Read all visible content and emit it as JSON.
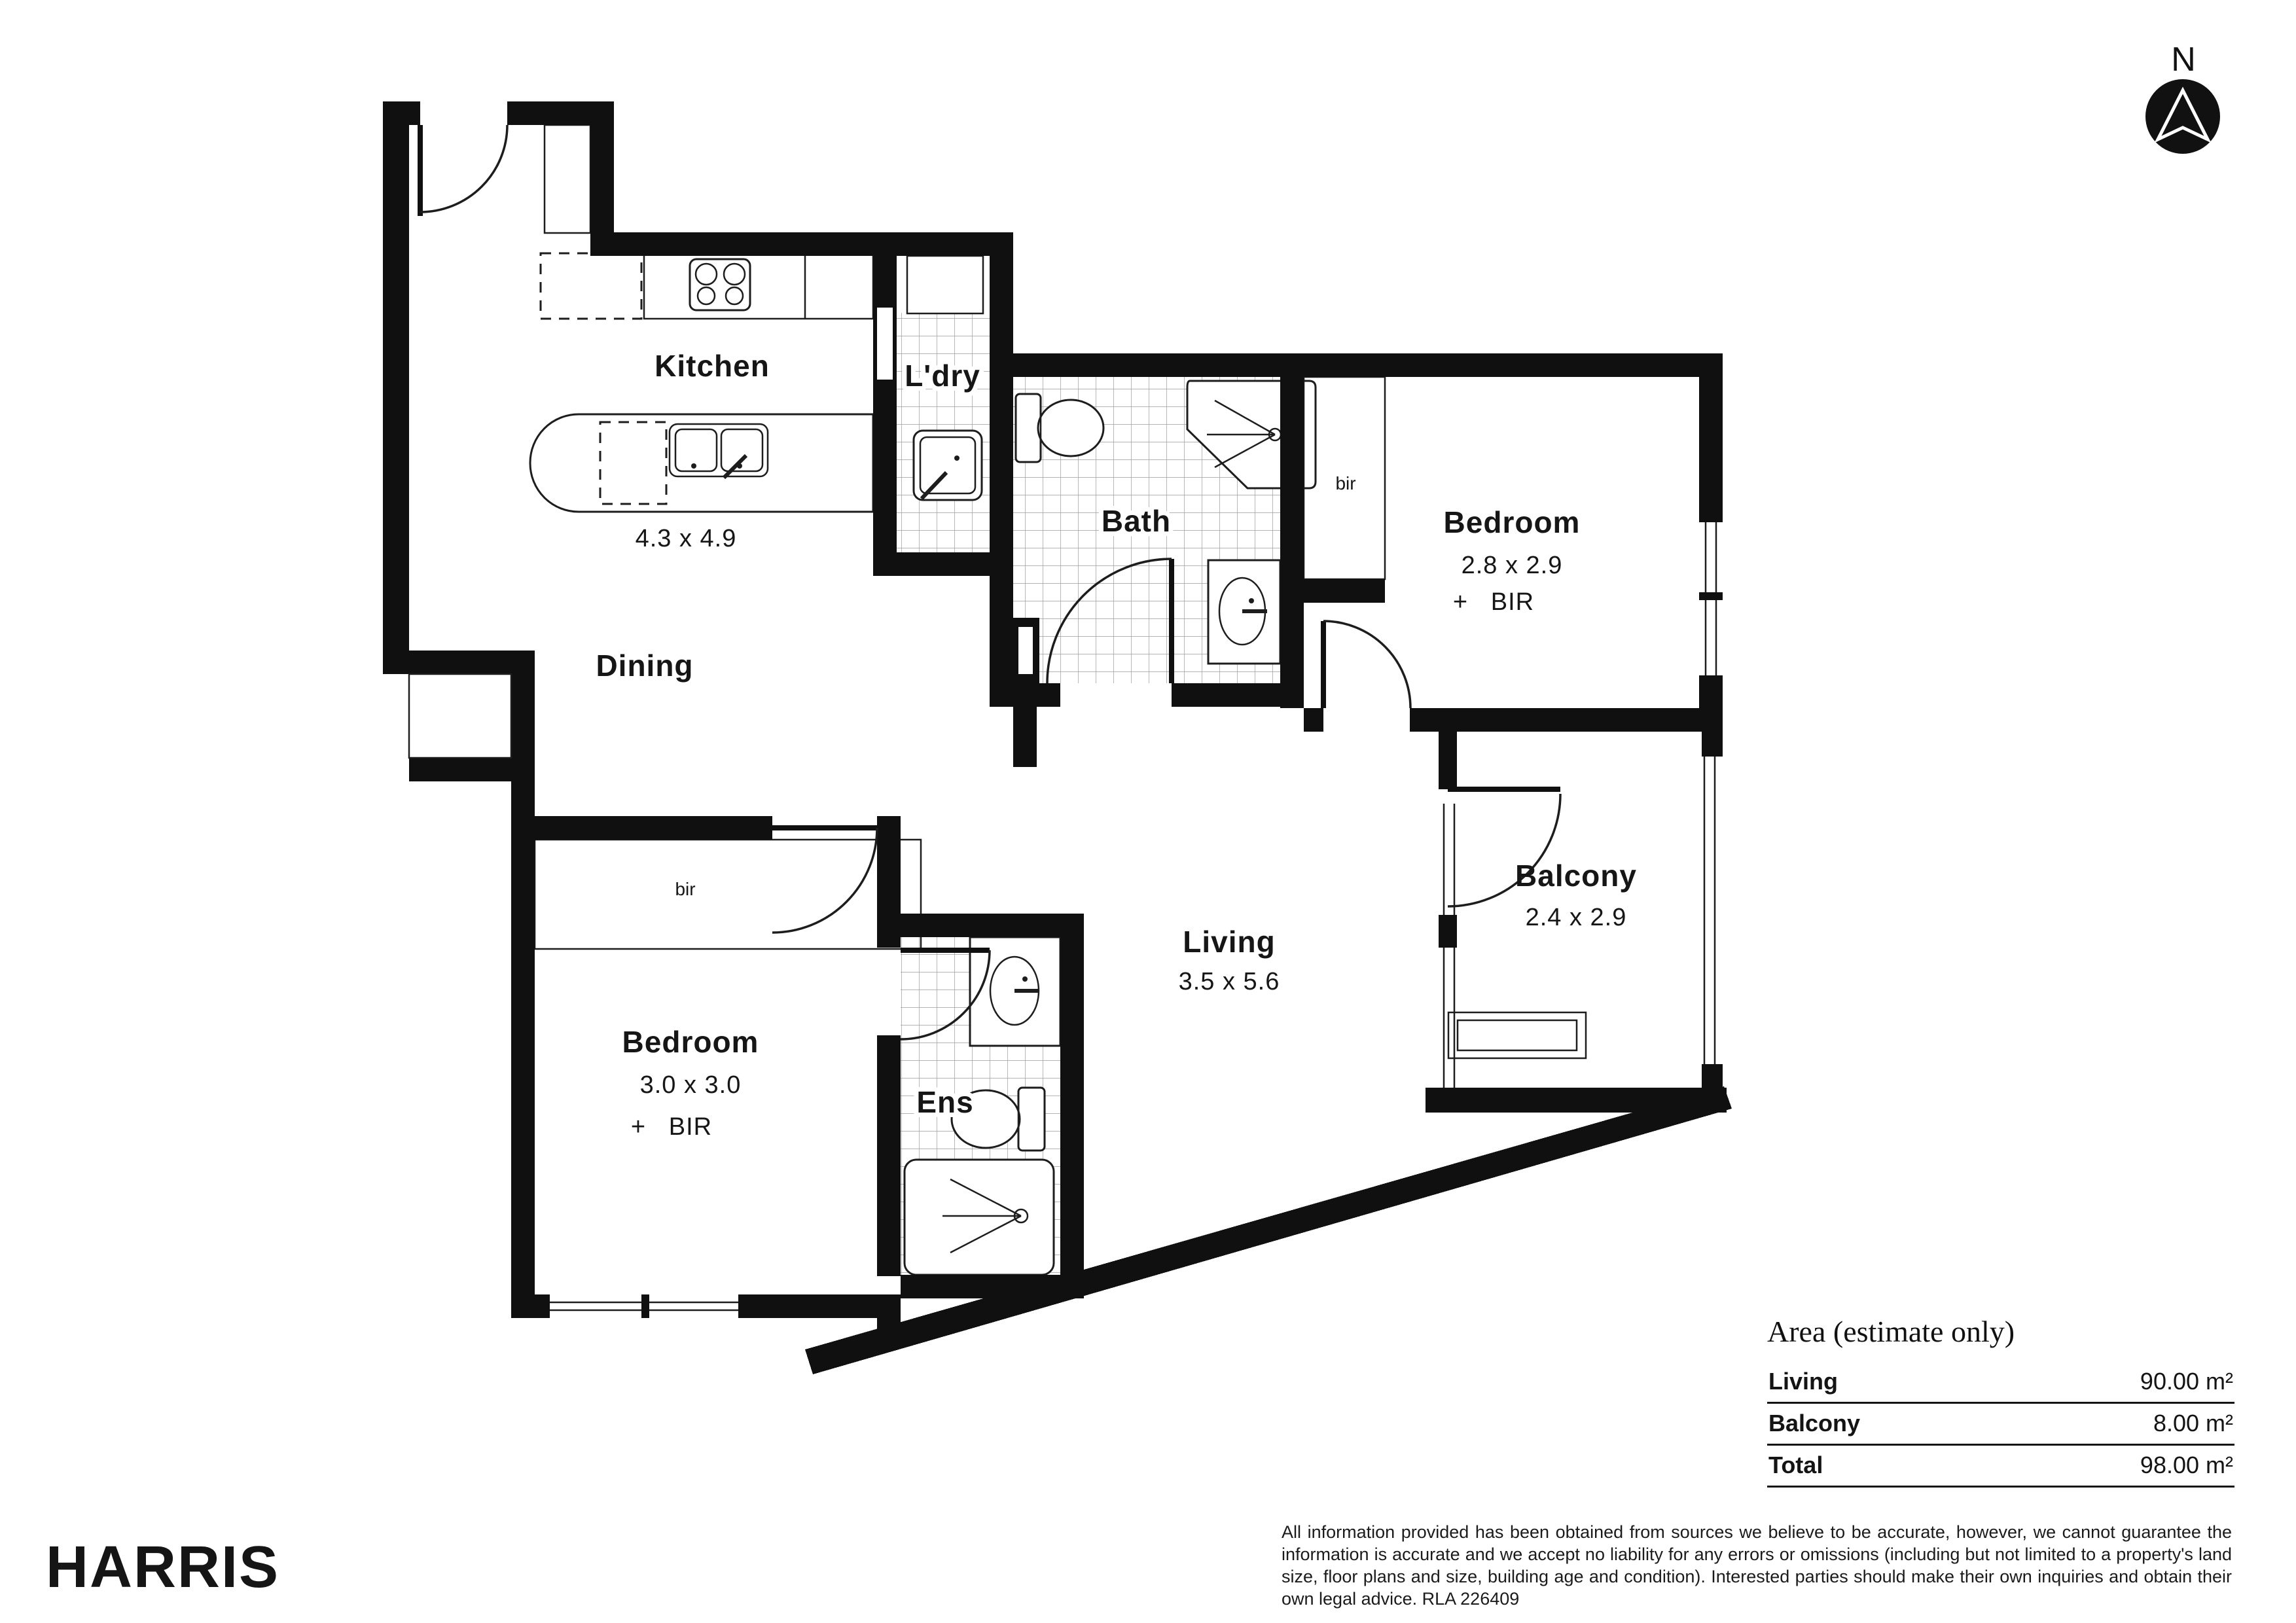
{
  "compass": {
    "label": "N"
  },
  "rooms": {
    "kitchen": {
      "label": "Kitchen",
      "dims": "4.3 x 4.9"
    },
    "laundry": {
      "label": "L'dry"
    },
    "bath": {
      "label": "Bath"
    },
    "dining": {
      "label": "Dining"
    },
    "living": {
      "label": "Living",
      "dims": "3.5 x 5.6"
    },
    "balcony": {
      "label": "Balcony",
      "dims": "2.4 x 2.9"
    },
    "bedroom1": {
      "label": "Bedroom",
      "dims": "2.8 x 2.9",
      "extra": "+   BIR",
      "robe": "bir"
    },
    "bedroom2": {
      "label": "Bedroom",
      "dims": "3.0 x 3.0",
      "extra": "+   BIR",
      "robe": "bir"
    },
    "ensuite": {
      "label": "Ens"
    }
  },
  "area_table": {
    "title": "Area (estimate only)",
    "rows": [
      {
        "label": "Living",
        "value": "90.00 m²"
      },
      {
        "label": "Balcony",
        "value": "8.00 m²"
      },
      {
        "label": "Total",
        "value": "98.00 m²"
      }
    ]
  },
  "footer": {
    "brand": "HARRIS",
    "disclaimer": "All information provided has been obtained from sources we believe to be accurate, however, we cannot guarantee the information is accurate and we accept no liability for any errors or omissions (including but not limited to a property's land size, floor plans and size, building age and condition). Interested parties should make their own inquiries and obtain their own legal advice. RLA 226409"
  },
  "colors": {
    "wall": "#101010",
    "tile_line": "#9a9a9a",
    "accent": "#111111"
  }
}
